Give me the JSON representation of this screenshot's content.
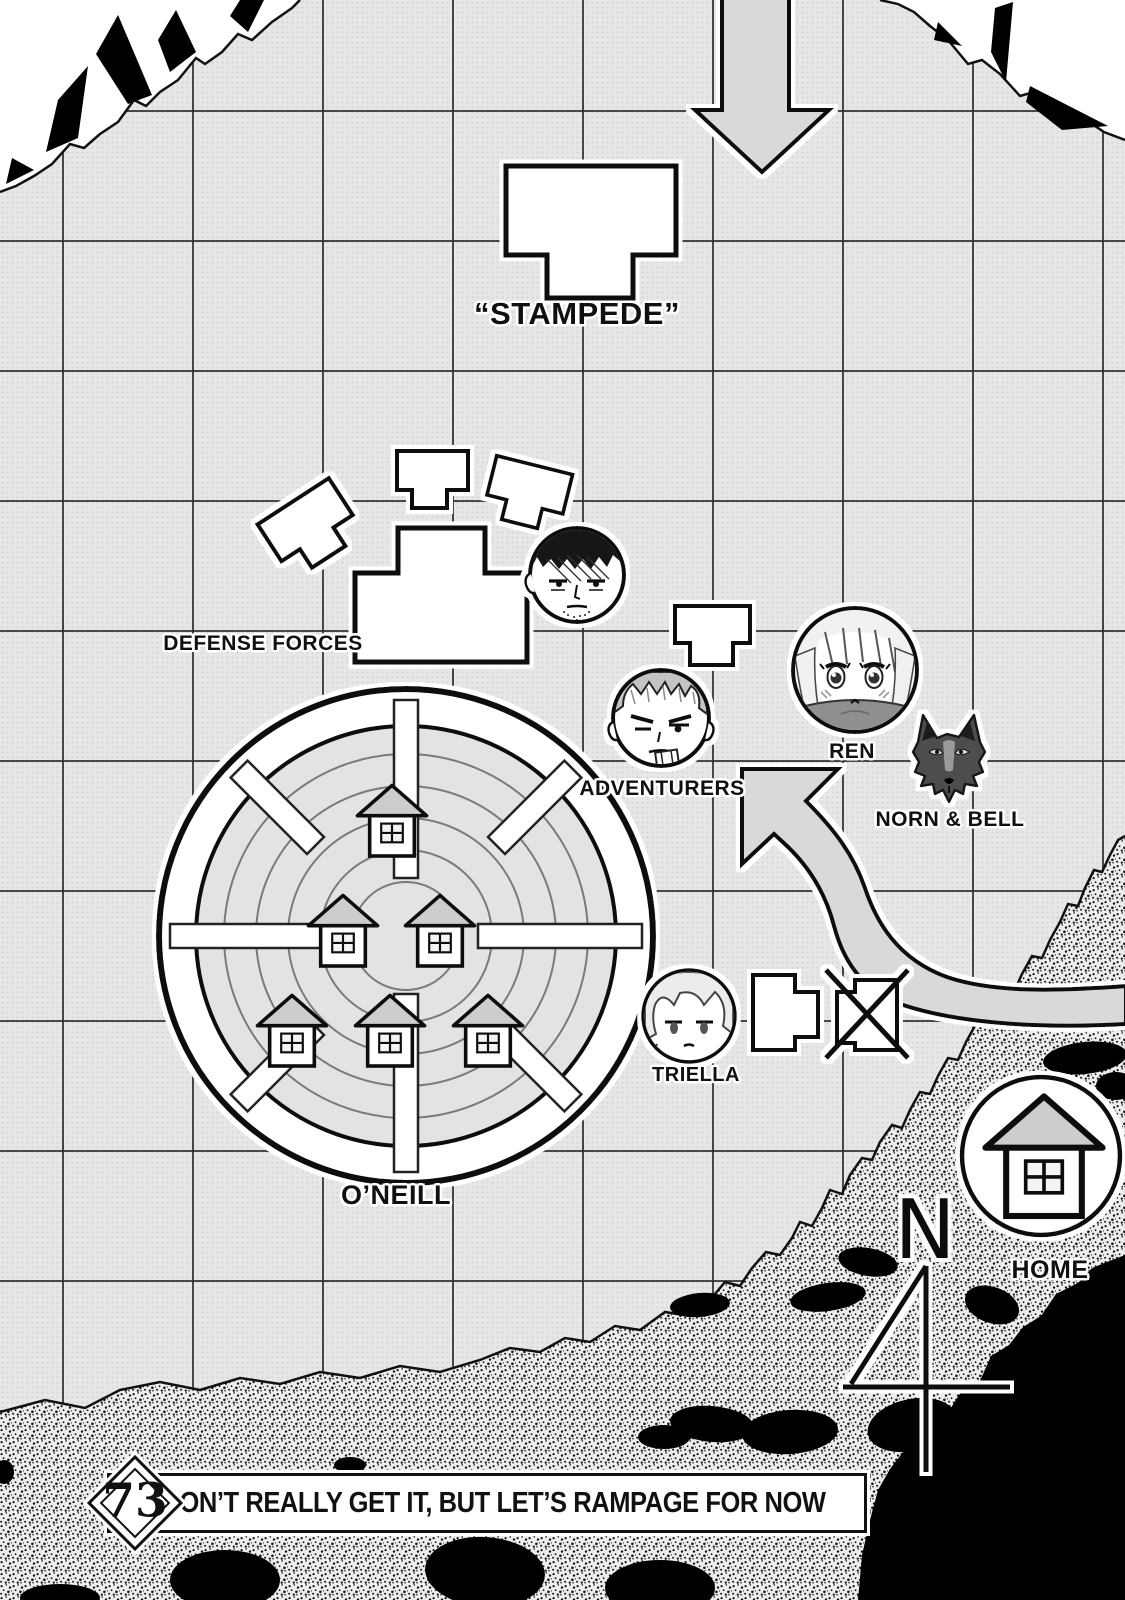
{
  "page_kind": "manga chapter title page with tactical map",
  "chapter": {
    "number": "73",
    "title": "I DON’T REALLY GET IT, BUT LET’S RAMPAGE FOR NOW"
  },
  "map": {
    "labels": {
      "stampede": "“STAMPEDE”",
      "defense_forces": "DEFENSE FORCES",
      "adventurers": "ADVENTURERS",
      "ren": "REN",
      "norn_bell": "NORN & BELL",
      "triella": "TRIELLA",
      "oneill": "O’NEILL",
      "home": "HOME"
    },
    "compass": {
      "north_letter": "N"
    },
    "markers": [
      {
        "id": "stampede",
        "label": "“STAMPEDE”",
        "icon": "monster-block-shape"
      },
      {
        "id": "defense-forces",
        "label": "DEFENSE FORCES",
        "icon": "unit-block-shapes"
      },
      {
        "id": "commander",
        "label": "",
        "icon": "commander-portrait"
      },
      {
        "id": "adventurers",
        "label": "ADVENTURERS",
        "icon": "adventurer-portrait"
      },
      {
        "id": "ren",
        "label": "REN",
        "icon": "girl-portrait"
      },
      {
        "id": "norn-bell",
        "label": "NORN & BELL",
        "icon": "wolf-head-icon"
      },
      {
        "id": "triella",
        "label": "TRIELLA",
        "icon": "girl-portrait"
      },
      {
        "id": "oneill",
        "label": "O’NEILL",
        "icon": "walled-city-icon"
      },
      {
        "id": "home",
        "label": "HOME",
        "icon": "house-icon"
      },
      {
        "id": "crossed-unit",
        "label": "",
        "icon": "crossed-out-block-shape"
      },
      {
        "id": "advance-arrow",
        "label": "",
        "icon": "curved-arrow-up-left"
      },
      {
        "id": "stampede-arrow",
        "label": "",
        "icon": "big-arrow-down"
      }
    ]
  },
  "colors": {
    "background": "#e7e7e7",
    "grid_line": "#2d2d2d",
    "arrow_fill": "#d9d9d9",
    "shape_fill": "#ffffff",
    "terrain_ink": "#000000",
    "roof_gray": "#cdcdcd"
  }
}
